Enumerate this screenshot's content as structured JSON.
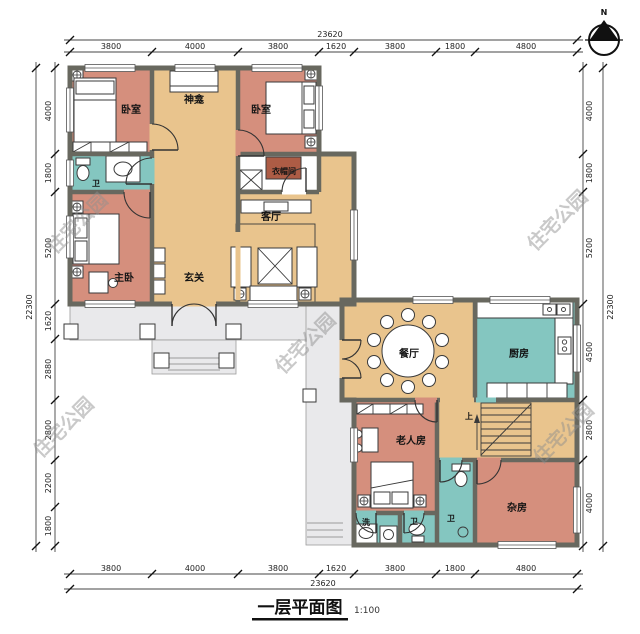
{
  "title": {
    "text": "一层平面图",
    "scale": "1:100"
  },
  "compass": {
    "north_label": "N"
  },
  "watermark_text": "住宅公园",
  "colors": {
    "wall": "#68685f",
    "bedroom": "#d58f7d",
    "hall": "#e9c48d",
    "wet": "#84c6c0",
    "terrace": "#e9e9eb",
    "dresser": "#ad5c45",
    "line": "#2a2a2a"
  },
  "dimensions": {
    "top": {
      "total": "23620",
      "segments": [
        "3800",
        "4000",
        "3800",
        "1620",
        "3800",
        "1800",
        "4800"
      ]
    },
    "bottom": {
      "total": "23620",
      "segments": [
        "3800",
        "4000",
        "3800",
        "1620",
        "3800",
        "1800",
        "4800"
      ]
    },
    "left": {
      "total": "22300",
      "segments": [
        "4000",
        "1800",
        "5200",
        "1620",
        "2880",
        "2800",
        "2200",
        "1800"
      ]
    },
    "right": {
      "total": "22300",
      "segments": [
        "4000",
        "1800",
        "5200",
        "4500",
        "2800",
        "4000"
      ]
    }
  },
  "rooms": {
    "bedroom_tl": "卧室",
    "shrine": "神龛",
    "bedroom_tr": "卧室",
    "bath_upper": "卫",
    "cloakroom": "衣帽间",
    "master_bedroom": "主卧",
    "foyer": "玄关",
    "living_room": "客厅",
    "dining_room": "餐厅",
    "kitchen": "厨房",
    "elder_room": "老人房",
    "bath_mid": "卫",
    "bath_small": "卫",
    "laundry": "洗",
    "storage": "杂房"
  },
  "stairs": {
    "up_label": "上"
  }
}
